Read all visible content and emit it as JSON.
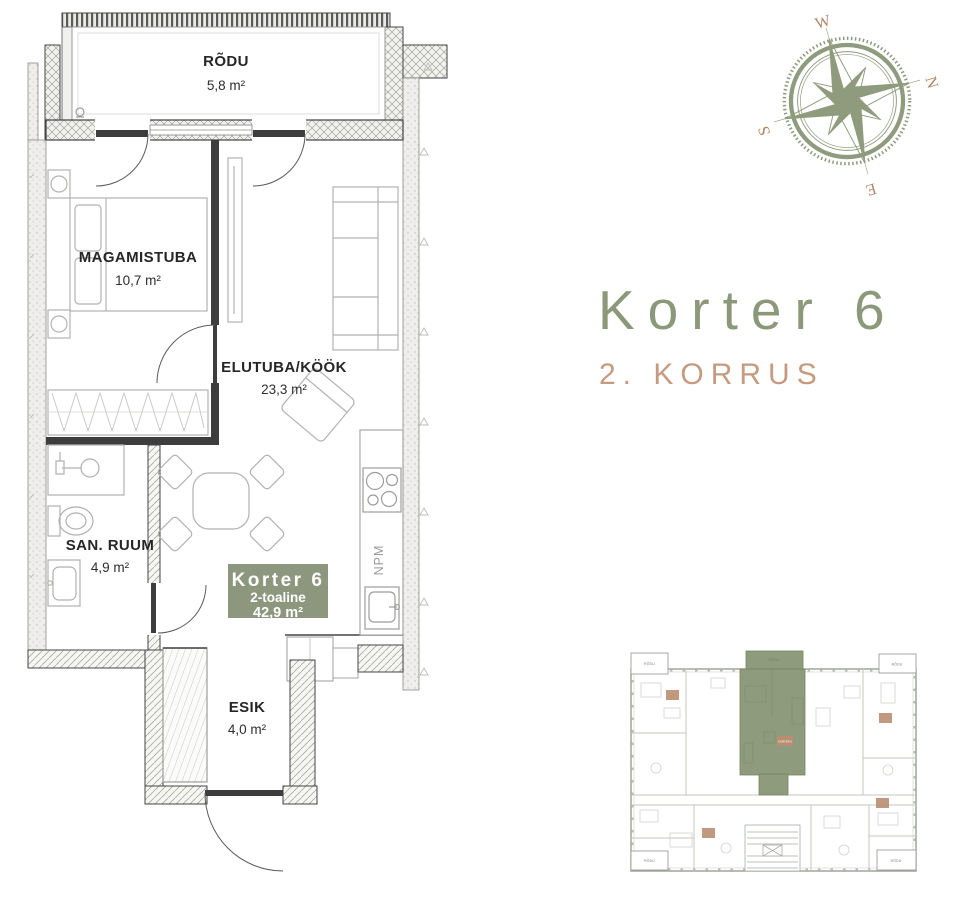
{
  "palette": {
    "sage": "#8d977d",
    "tan": "#bd9276",
    "wall_dark": "#3d3d3d",
    "furniture_gray": "#b2b2b0",
    "text_dark": "#262626"
  },
  "title": {
    "heading": "Korter 6",
    "subheading": "2. KORRUS"
  },
  "compass": {
    "west": "W",
    "north": "N",
    "south": "S",
    "east": "E"
  },
  "plan": {
    "rooms": [
      {
        "name": "RÕDU",
        "area": "5,8 m²"
      },
      {
        "name": "MAGAMISTUBA",
        "area": "10,7 m²"
      },
      {
        "name": "ELUTUBA/KÖÖK",
        "area": "23,3 m²"
      },
      {
        "name": "SAN. RUUM",
        "area": "4,9 m²"
      },
      {
        "name": "ESIK",
        "area": "4,0 m²"
      }
    ],
    "badge": {
      "name": "Korter 6",
      "type": "2-toaline",
      "area": "42,9 m²"
    },
    "appliance_label": "NPM"
  },
  "minimap": {
    "balcony_label": "RÕDU",
    "highlight_label": "KORTER 6"
  }
}
